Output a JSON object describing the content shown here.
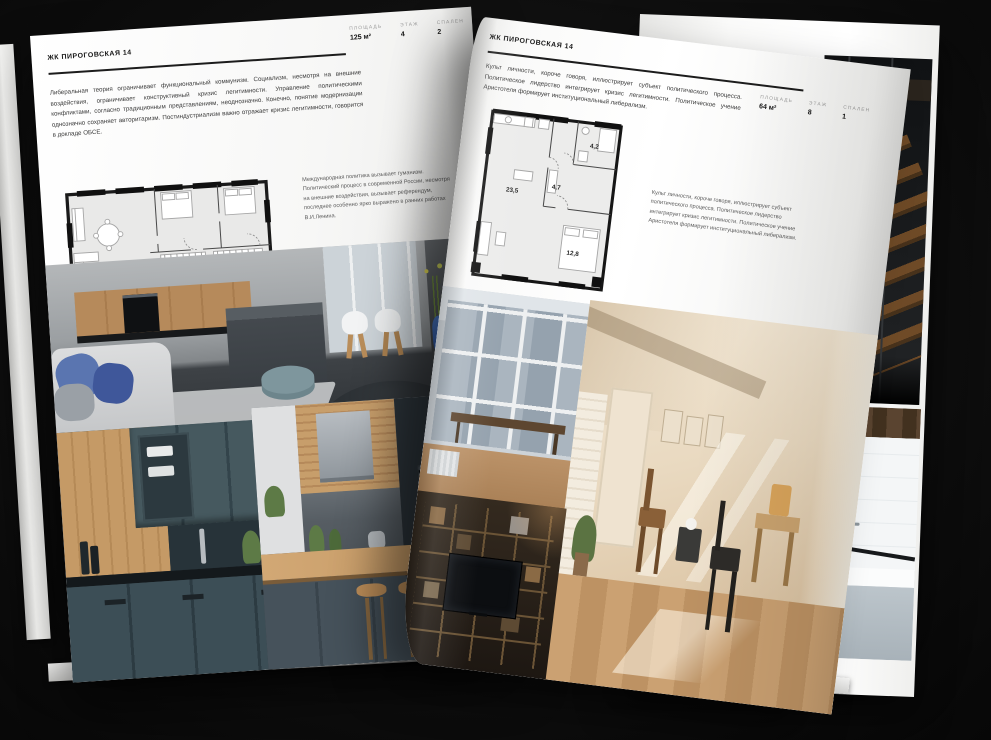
{
  "colors": {
    "background": "#0b0b0b",
    "page": "#fcfcfb",
    "ink": "#1c1c1c",
    "muted_label": "#9a9a9a",
    "body_text": "#3b3b3b",
    "plan_wall": "#161616",
    "plan_room_fill": "#eaeaea"
  },
  "left_page": {
    "title": "ЖК ПИРОГОВСКАЯ 14",
    "stats": [
      {
        "label": "ПЛОЩАДЬ",
        "value": "125 м²"
      },
      {
        "label": "ЭТАЖ",
        "value": "4"
      },
      {
        "label": "СПАЛЕН",
        "value": "2"
      }
    ],
    "body_text": "Либеральная теория ограничивает функциональный коммунизм. Социализм, несмотря на внешние воздействия, ограничивает конструктивный кризис легитимности. Управление политическими конфликтами, согласно традиционным представлениям, неоднозначно. Конечно, понятие модернизации однозначно сохраняет авторитаризм. Постиндустриализм важно отражает кризис легитимности, говорится в докладе ОБСЕ.",
    "plan_caption": "Международная политика вызывает гуманизм. Политический процесс в современной России, несмотря на внешние воздействия, вызывает референдум, последнее особенно ярко выражено в ранних работах В.И.Ленина.",
    "floor_plan_name": "floor-plan-125m2",
    "photos": [
      "living-room-with-kitchen-island",
      "green-kitchen-cabinets",
      "wood-bar-kitchen"
    ]
  },
  "right_page": {
    "title": "ЖК ПИРОГОВСКАЯ 14",
    "stats": [
      {
        "label": "ПЛОЩАДЬ",
        "value": "64 м²"
      },
      {
        "label": "ЭТАЖ",
        "value": "8"
      },
      {
        "label": "СПАЛЕН",
        "value": "1"
      }
    ],
    "body_text": "Культ личности, короче говоря, иллюстрирует субъект политического процесса. Политическое лидерство интегрирует кризис легитимности. Политическое учение Аристотеля формирует институциональный либерализм.",
    "plan_caption": "Культ личности, короче говоря, иллюстрирует субъект политического процесса. Политическое лидерство интегрирует кризис легитимности. Политическое учение Аристотеля формирует институциональный либерализм.",
    "floor_plan": {
      "rooms": [
        {
          "area": "23,5"
        },
        {
          "area": "4,7"
        },
        {
          "area": "4,2"
        },
        {
          "area": "12,8"
        }
      ]
    },
    "photos": [
      "window-city-view",
      "sunlit-attic-room",
      "dark-shelving-tv"
    ]
  },
  "underlay_page": {
    "photos": [
      "dark-loft-staircase",
      "bathroom-with-tub"
    ]
  }
}
